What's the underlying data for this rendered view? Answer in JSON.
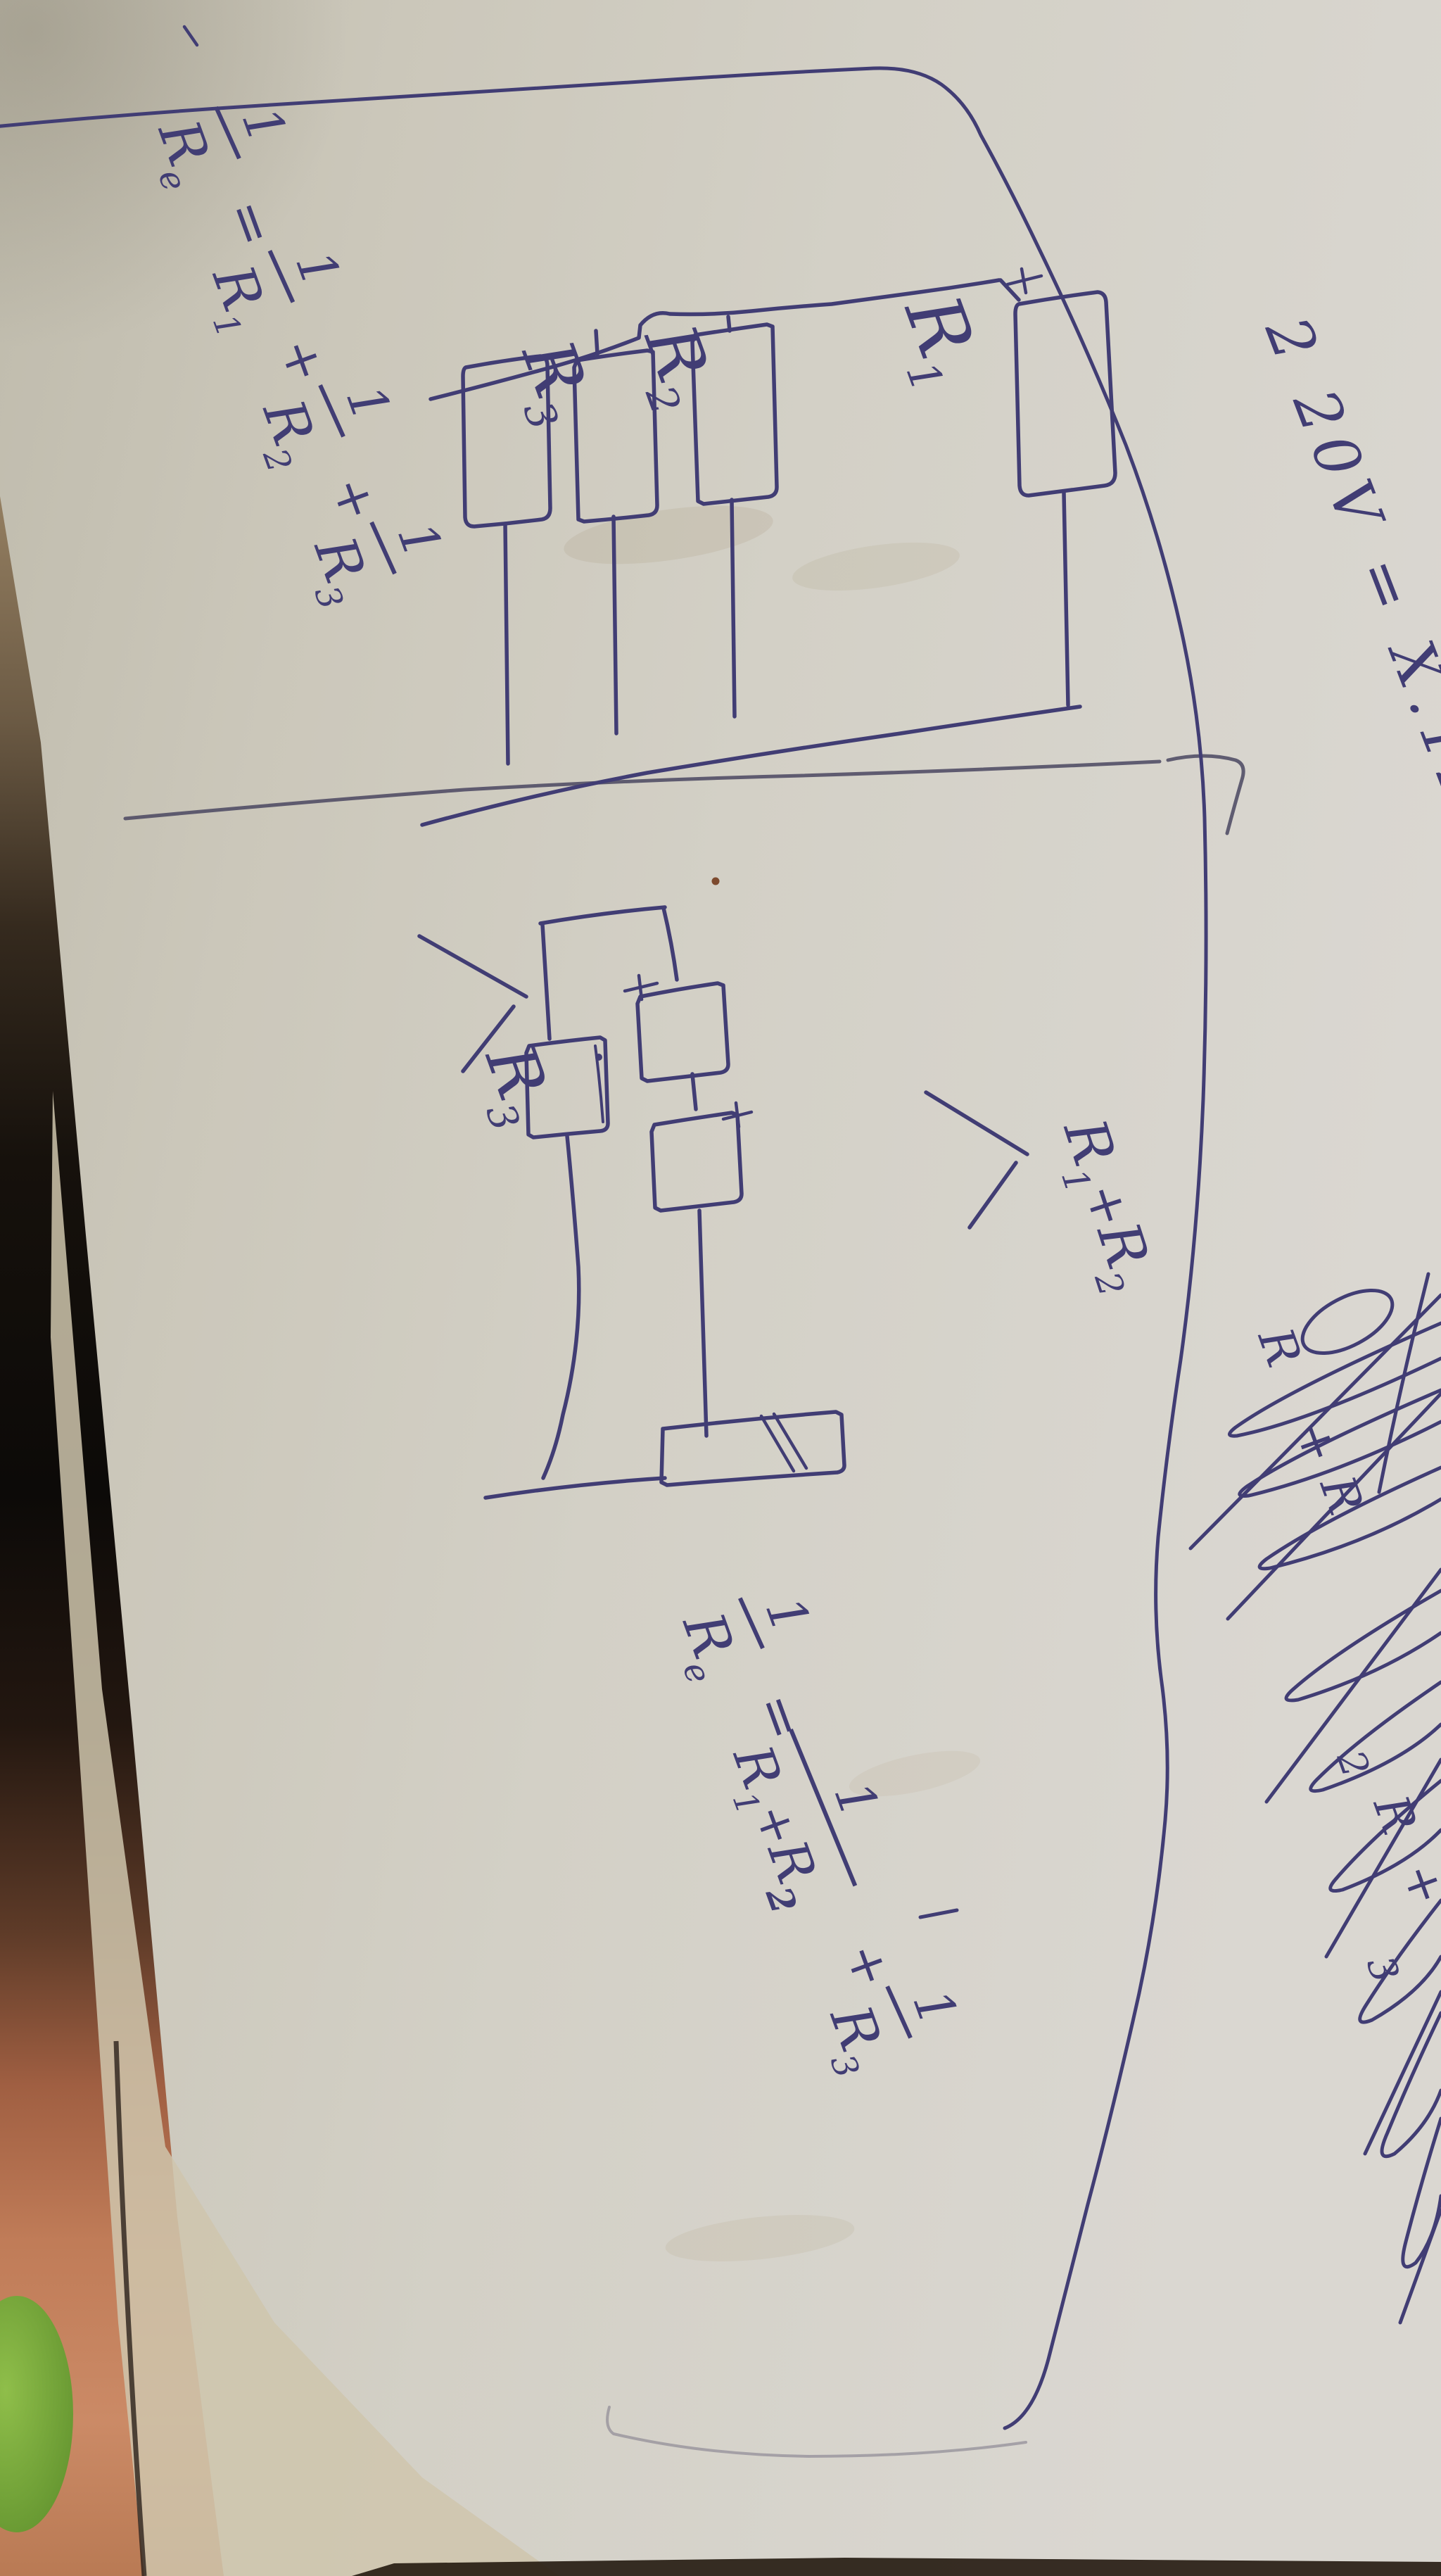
{
  "caption": {
    "text": "2 20V = X.1232.01"
  },
  "formula_parallel": {
    "lhs": {
      "num": "1",
      "den_base": "R",
      "den_sub": "e"
    },
    "equals": "=",
    "plus": "+",
    "terms": [
      {
        "num": "1",
        "den_base": "R",
        "den_sub": "1"
      },
      {
        "num": "1",
        "den_base": "R",
        "den_sub": "2"
      },
      {
        "num": "1",
        "den_base": "R",
        "den_sub": "3"
      }
    ]
  },
  "circuit_parallel": {
    "labels": [
      {
        "base": "R",
        "sub": "3"
      },
      {
        "base": "R",
        "sub": "2"
      },
      {
        "base": "R",
        "sub": "1"
      }
    ]
  },
  "circuit_series_parallel": {
    "r3": {
      "base": "R",
      "sub": "3"
    },
    "series_annotation": {
      "r1_base": "R",
      "r1_sub": "1",
      "plus": "+",
      "r2_base": "R",
      "r2_sub": "2"
    }
  },
  "formula_series": {
    "lhs": {
      "num": "1",
      "den_base": "R",
      "den_sub": "e"
    },
    "equals": "=",
    "plus": "+",
    "term1": {
      "num": "1",
      "den": {
        "r1_base": "R",
        "r1_sub": "1",
        "plus": "+",
        "r2_base": "R",
        "r2_sub": "2"
      }
    },
    "term2": {
      "num": "1",
      "den_base": "R",
      "den_sub": "3"
    }
  },
  "scribbles": {
    "fragments": [
      "R",
      "+",
      "R",
      "2",
      "R",
      "+",
      "3"
    ]
  },
  "colors": {
    "ink": "#413d74",
    "ink_light": "#55517f",
    "pencil": "#8f8a96",
    "divider": "#4a4660",
    "paper": "#d2cfc5",
    "under_sheet": "#d0c7ae",
    "desk_tan": "#ad9878",
    "desk_dark": "#16110c",
    "desk_salmon": "#c6875f",
    "leaf_green": "#7fae3e",
    "band_dark": "#241a10",
    "speck_brown": "#7d4a2e"
  }
}
